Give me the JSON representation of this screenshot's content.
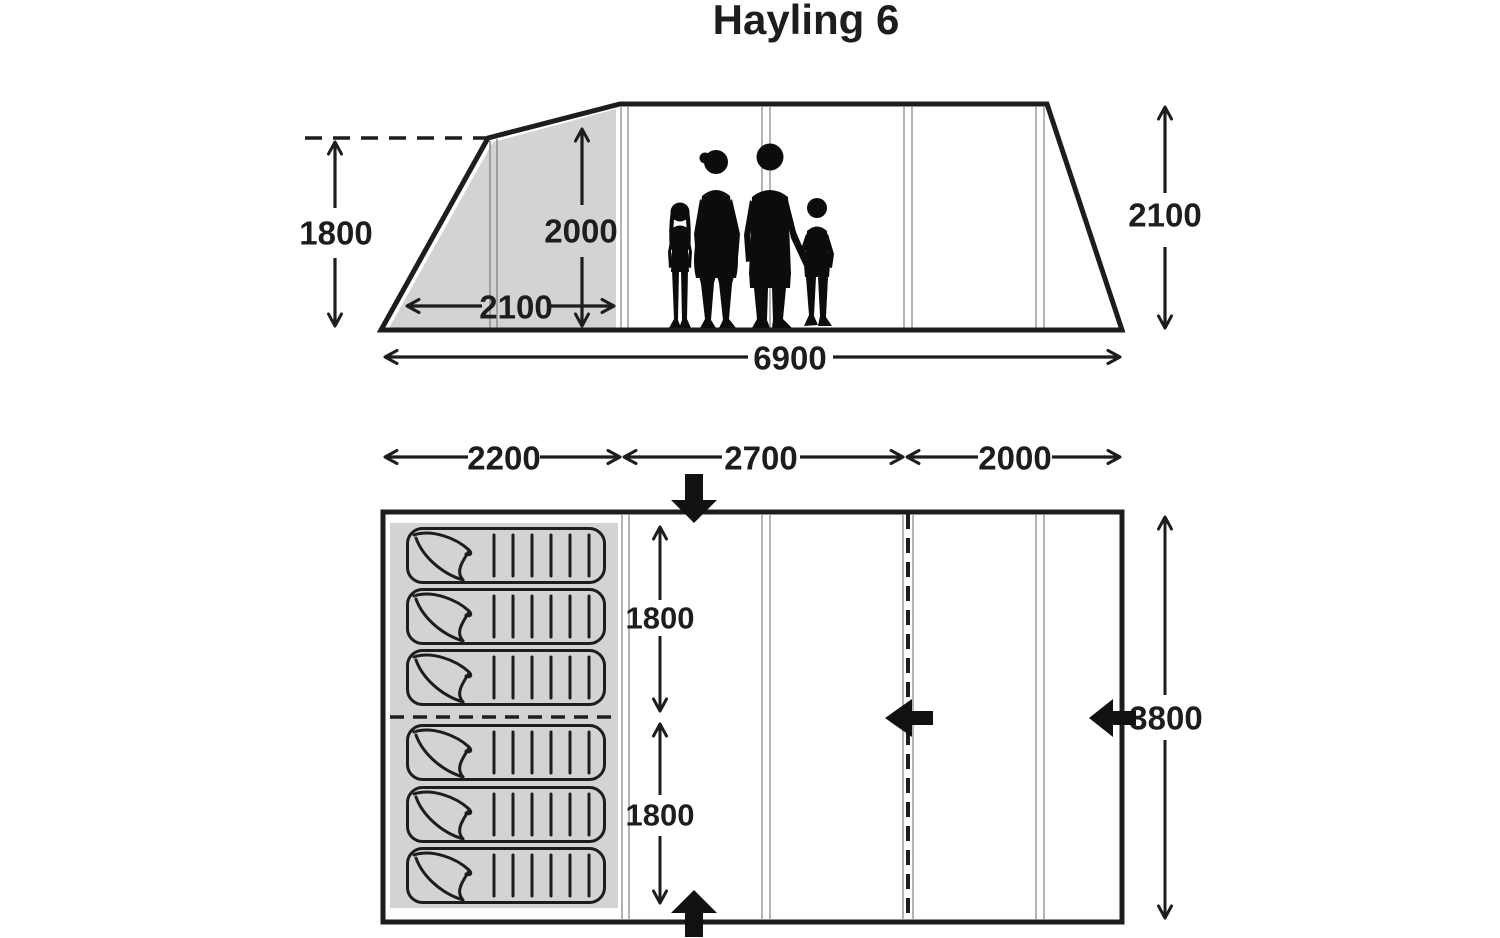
{
  "title": "Hayling 6",
  "colors": {
    "line": "#1d1d1b",
    "inner_tent_gray": "#d3d3d3",
    "seam_gray": "#b4b4b4",
    "silhouette": "#0c0c0c"
  },
  "side_elevation": {
    "front_peak_height": "1800",
    "inner_tent_height": "2000",
    "inner_tent_depth": "2100",
    "main_height": "2100",
    "total_length": "6900",
    "figures_icon": "family-of-four-silhouette"
  },
  "floor_plan": {
    "section_widths": [
      "2200",
      "2700",
      "2000"
    ],
    "bedroom_lengths": [
      "1800",
      "1800"
    ],
    "total_width": "3800",
    "sleeping_bags": 6,
    "door_arrow_icons": [
      "front-top-door-arrow",
      "front-bottom-door-arrow",
      "inner-divider-door-arrow",
      "side-door-arrow"
    ]
  }
}
